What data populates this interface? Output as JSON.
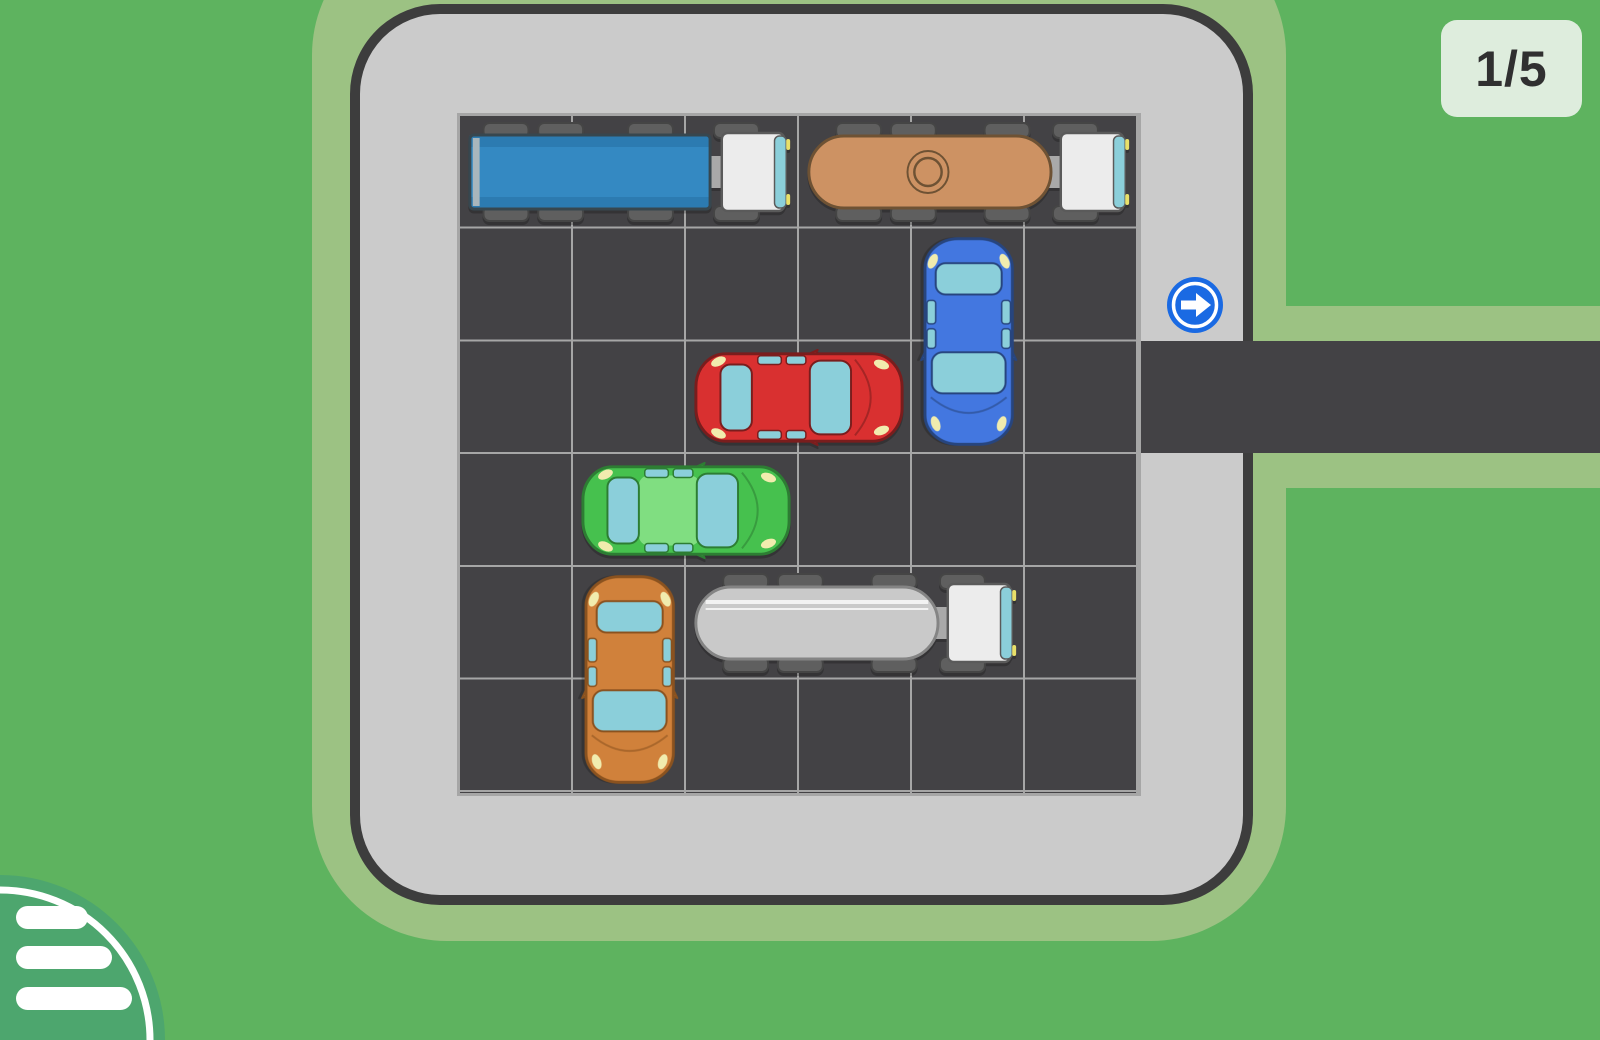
{
  "hud": {
    "level_label": "1/5"
  },
  "palette": {
    "grass": "#5eb35f",
    "path_halo": "#9cc283",
    "lot_floor": "#cbcbcb",
    "lot_border": "#3d3d3d",
    "asphalt": "#434245",
    "grid_line": "#a6a6a6",
    "exit_blue": "#1a6ae3",
    "badge_bg": "#deeddd",
    "badge_text": "#303030",
    "menu_green": "#4da66e",
    "glass": "#8bcfda",
    "headlight": "#f1ecae",
    "wheel": "#5f5f5f"
  },
  "board": {
    "rows": 6,
    "cols": 6,
    "exit": {
      "row": 3,
      "side": "right",
      "icon": "exit-arrow-icon"
    },
    "vehicles": [
      {
        "id": "blue-semi-truck",
        "kind": "semi",
        "row": 1,
        "col": 1,
        "length": 3,
        "orientation": "horizontal",
        "facing": "right",
        "colors": {
          "body": "#3489c2",
          "stripe": "#2c7bb1",
          "outline": "#37474f"
        }
      },
      {
        "id": "brown-tanker-truck",
        "kind": "tanker-cap",
        "row": 1,
        "col": 4,
        "length": 3,
        "orientation": "horizontal",
        "facing": "right",
        "colors": {
          "body": "#cd9263",
          "outline": "#6e5234"
        }
      },
      {
        "id": "blue-car",
        "kind": "car",
        "row": 2,
        "col": 5,
        "length": 2,
        "orientation": "vertical",
        "facing": "down",
        "colors": {
          "body": "#4377e0",
          "outline": "#27457e"
        }
      },
      {
        "id": "red-car",
        "kind": "car",
        "row": 3,
        "col": 3,
        "length": 2,
        "orientation": "horizontal",
        "facing": "right",
        "colors": {
          "body": "#d93030",
          "outline": "#7a1d1d"
        }
      },
      {
        "id": "green-car",
        "kind": "car",
        "row": 4,
        "col": 2,
        "length": 2,
        "orientation": "horizontal",
        "facing": "right",
        "colors": {
          "body": "#46c14e",
          "roof": "#80de81",
          "outline": "#2d7d33"
        }
      },
      {
        "id": "orange-car",
        "kind": "car",
        "row": 5,
        "col": 2,
        "length": 2,
        "orientation": "vertical",
        "facing": "down",
        "colors": {
          "body": "#d0813b",
          "outline": "#8a521f"
        }
      },
      {
        "id": "white-tanker-truck",
        "kind": "tanker-stripe",
        "row": 5,
        "col": 3,
        "length": 3,
        "orientation": "horizontal",
        "facing": "right",
        "colors": {
          "body": "#c9c9c9",
          "outline": "#848484"
        }
      }
    ]
  },
  "menu": {
    "icon": "menu-icon"
  }
}
